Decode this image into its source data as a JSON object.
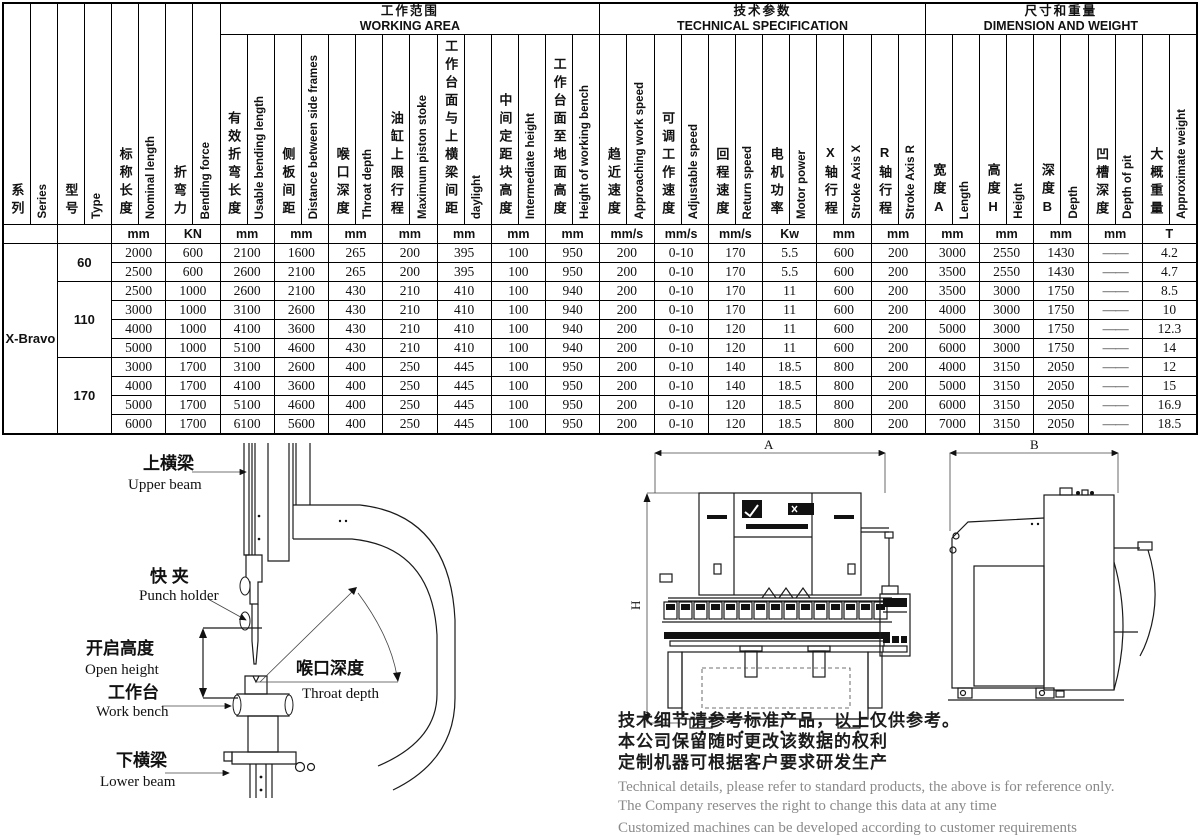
{
  "table": {
    "series": "X-Bravo",
    "groups": [
      {
        "zh": "工作范围",
        "en": "WORKING AREA",
        "cols": 7
      },
      {
        "zh": "技术参数",
        "en": "TECHNICAL SPECIFICATION",
        "cols": 6
      },
      {
        "zh": "尺寸和重量",
        "en": "DIMENSION AND WEIGHT",
        "cols": 5
      }
    ],
    "columns": [
      {
        "zh": "系列",
        "en": "Series",
        "unit": ""
      },
      {
        "zh": "型号",
        "en": "Type",
        "unit": ""
      },
      {
        "zh": "标称长度",
        "en": "Nominal length",
        "unit": "mm"
      },
      {
        "zh": "折弯力",
        "en": "Bending force",
        "unit": "KN"
      },
      {
        "zh": "有效折弯长度",
        "en": "Usable bending length",
        "unit": "mm"
      },
      {
        "zh": "侧板间距",
        "en": "Distance between side frames",
        "unit": "mm"
      },
      {
        "zh": "喉口深度",
        "en": "Throat depth",
        "unit": "mm"
      },
      {
        "zh": "油缸上限行程",
        "en": "Maximum piston stoke",
        "unit": "mm"
      },
      {
        "zh": "工作台面与上横梁间距",
        "en": "daylight",
        "unit": "mm"
      },
      {
        "zh": "中间定距块高度",
        "en": "Intermediate height",
        "unit": "mm"
      },
      {
        "zh": "工作台面至地面高度",
        "en": "Height of working bench",
        "unit": "mm"
      },
      {
        "zh": "趋近速度",
        "en": "Approaching work speed",
        "unit": "mm/s"
      },
      {
        "zh": "可调工作速度",
        "en": "Adjustable speed",
        "unit": "mm/s"
      },
      {
        "zh": "回程速度",
        "en": "Return speed",
        "unit": "mm/s"
      },
      {
        "zh": "电机功率",
        "en": "Motor power",
        "unit": "Kw"
      },
      {
        "zh": "X轴行程",
        "en": "Stroke Axis X",
        "unit": "mm"
      },
      {
        "zh": "R轴行程",
        "en": "Stroke Axis R",
        "unit": "mm"
      },
      {
        "zh": "宽度A",
        "en": "Length",
        "unit": "mm"
      },
      {
        "zh": "高度H",
        "en": "Height",
        "unit": "mm"
      },
      {
        "zh": "深度B",
        "en": "Depth",
        "unit": "mm"
      },
      {
        "zh": "凹槽深度",
        "en": "Depth of pit",
        "unit": "mm"
      },
      {
        "zh": "大概重量",
        "en": "Approximate weight",
        "unit": "T"
      }
    ],
    "type_groups": [
      {
        "type": "60",
        "start": 0,
        "rows": 2
      },
      {
        "type": "110",
        "start": 2,
        "rows": 4
      },
      {
        "type": "170",
        "start": 6,
        "rows": 4
      }
    ],
    "rows": [
      [
        "2000",
        "600",
        "2100",
        "1600",
        "265",
        "200",
        "395",
        "100",
        "950",
        "200",
        "0-10",
        "170",
        "5.5",
        "600",
        "200",
        "3000",
        "2550",
        "1430",
        "——",
        "4.2"
      ],
      [
        "2500",
        "600",
        "2600",
        "2100",
        "265",
        "200",
        "395",
        "100",
        "950",
        "200",
        "0-10",
        "170",
        "5.5",
        "600",
        "200",
        "3500",
        "2550",
        "1430",
        "——",
        "4.7"
      ],
      [
        "2500",
        "1000",
        "2600",
        "2100",
        "430",
        "210",
        "410",
        "100",
        "940",
        "200",
        "0-10",
        "170",
        "11",
        "600",
        "200",
        "3500",
        "3000",
        "1750",
        "——",
        "8.5"
      ],
      [
        "3000",
        "1000",
        "3100",
        "2600",
        "430",
        "210",
        "410",
        "100",
        "940",
        "200",
        "0-10",
        "170",
        "11",
        "600",
        "200",
        "4000",
        "3000",
        "1750",
        "——",
        "10"
      ],
      [
        "4000",
        "1000",
        "4100",
        "3600",
        "430",
        "210",
        "410",
        "100",
        "940",
        "200",
        "0-10",
        "120",
        "11",
        "600",
        "200",
        "5000",
        "3000",
        "1750",
        "——",
        "12.3"
      ],
      [
        "5000",
        "1000",
        "5100",
        "4600",
        "430",
        "210",
        "410",
        "100",
        "940",
        "200",
        "0-10",
        "120",
        "11",
        "600",
        "200",
        "6000",
        "3000",
        "1750",
        "——",
        "14"
      ],
      [
        "3000",
        "1700",
        "3100",
        "2600",
        "400",
        "250",
        "445",
        "100",
        "950",
        "200",
        "0-10",
        "140",
        "18.5",
        "800",
        "200",
        "4000",
        "3150",
        "2050",
        "——",
        "12"
      ],
      [
        "4000",
        "1700",
        "4100",
        "3600",
        "400",
        "250",
        "445",
        "100",
        "950",
        "200",
        "0-10",
        "140",
        "18.5",
        "800",
        "200",
        "5000",
        "3150",
        "2050",
        "——",
        "15"
      ],
      [
        "5000",
        "1700",
        "5100",
        "4600",
        "400",
        "250",
        "445",
        "100",
        "950",
        "200",
        "0-10",
        "120",
        "18.5",
        "800",
        "200",
        "6000",
        "3150",
        "2050",
        "——",
        "16.9"
      ],
      [
        "6000",
        "1700",
        "6100",
        "5600",
        "400",
        "250",
        "445",
        "100",
        "950",
        "200",
        "0-10",
        "120",
        "18.5",
        "800",
        "200",
        "7000",
        "3150",
        "2050",
        "——",
        "18.5"
      ]
    ]
  },
  "diagram": {
    "labels": {
      "upper_beam": {
        "zh": "上横梁",
        "en": "Upper beam"
      },
      "punch_holder": {
        "zh": "快 夹",
        "en": "Punch holder"
      },
      "open_height": {
        "zh": "开启高度",
        "en": "Open height"
      },
      "throat_depth": {
        "zh": "喉口深度",
        "en": "Throat depth"
      },
      "work_bench": {
        "zh": "工作台",
        "en": "Work bench"
      },
      "lower_beam": {
        "zh": "下横梁",
        "en": "Lower beam"
      }
    }
  },
  "drawings": {
    "dim_a": "A",
    "dim_b": "B",
    "dim_h": "H"
  },
  "disclaimer": {
    "zh1": "技术细节请参考标准产品，以上仅供参考。",
    "zh2": "本公司保留随时更改该数据的权利",
    "zh3": "定制机器可根据客户要求研发生产",
    "en1": "Technical details, please refer to standard products, the above is for reference only.",
    "en2": "The Company reserves the right to change this data at any time",
    "en3": "Customized machines can be developed according to customer requirements"
  }
}
